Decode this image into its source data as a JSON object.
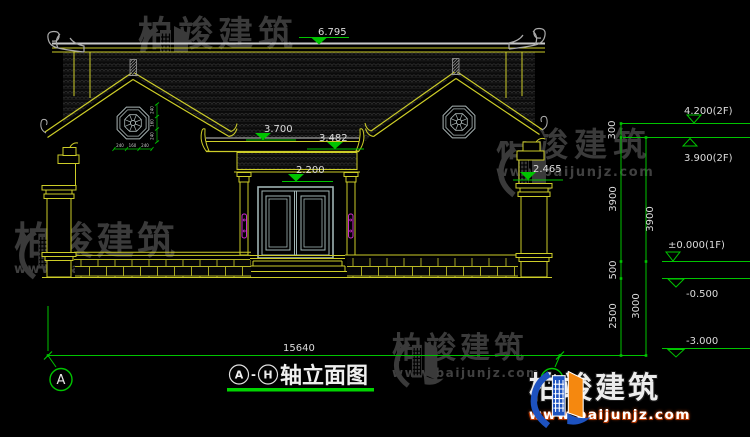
{
  "brand": {
    "name": "柏竣建筑",
    "url": "www.baijunjz.com"
  },
  "title": {
    "axis_start": "A",
    "dash": "-",
    "axis_end": "H",
    "text": "轴立面图"
  },
  "axis_bubbles": {
    "left": "A",
    "right": "H"
  },
  "dims": {
    "ridge": "6.795",
    "porch_upper": "3.700",
    "porch_lower": "3.482",
    "door": "2.200",
    "right_wall": "2.465",
    "total_width": "15640",
    "window_chain_h": [
      "240",
      "160",
      "240"
    ],
    "window_chain_v": [
      "240",
      "160",
      "240"
    ]
  },
  "levels": {
    "f2_top": "4.200(2F)",
    "f2": "3.900(2F)",
    "f1": "±0.000(1F)",
    "minus_05": "-0.500",
    "minus_3": "-3.000"
  },
  "chains": {
    "c300": "300",
    "c3900_a": "3900",
    "c3900_b": "3900",
    "c500": "500",
    "c2500": "2500",
    "c3000": "3000"
  },
  "colors": {
    "line_yellow": "#cdcd28",
    "dim_green": "#00c400",
    "text_white": "#dcdcdc",
    "accent_magenta": "#cc2ccc",
    "logo_blue": "#1d52c0",
    "logo_orange": "#f5880f",
    "watermark_gray": "#3a3a3a",
    "background": "#000000"
  }
}
